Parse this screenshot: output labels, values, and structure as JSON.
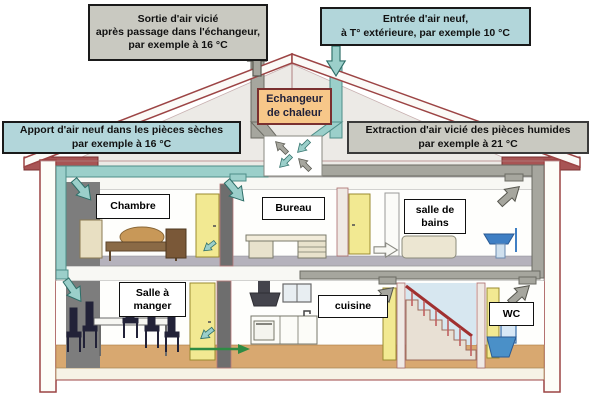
{
  "diagram": {
    "callouts": {
      "exhaust_outlet": "Sortie d'air vicié\naprès passage dans l'échangeur,\npar exemple à 16 °C",
      "fresh_air_intake": "Entrée d'air neuf,\nà T° extérieure, par exemple 10 °C",
      "heat_exchanger": "Echangeur\nde chaleur",
      "supply_dry_rooms": "Apport d'air neuf dans les pièces sèches\npar exemple à 16 °C",
      "extract_humid_rooms": "Extraction d'air vicié des pièces humides\npar exemple à 21 °C"
    },
    "rooms": {
      "chambre": "Chambre",
      "bureau": "Bureau",
      "salle_de_bains": "salle de\nbains",
      "salle_a_manger": "Salle à\nmanger",
      "cuisine": "cuisine",
      "wc": "WC"
    },
    "temperatures": {
      "exhaust_after_exchanger": "16 °C",
      "outside_air": "10 °C",
      "supplied_air": "16 °C",
      "extracted_air": "21 °C"
    },
    "colors": {
      "supply_air_teal": "#9bcfca",
      "exhaust_air_gray": "#a6a69e",
      "callout_blue": "#b2d6da",
      "callout_gray": "#c9c9c1",
      "exchanger_orange": "#f7c789",
      "roof_outline_red": "#9c4444",
      "floor_wood_tan": "#d8a870",
      "door_yellow": "#f2e992",
      "transfer_green": "#2e8b44"
    }
  }
}
